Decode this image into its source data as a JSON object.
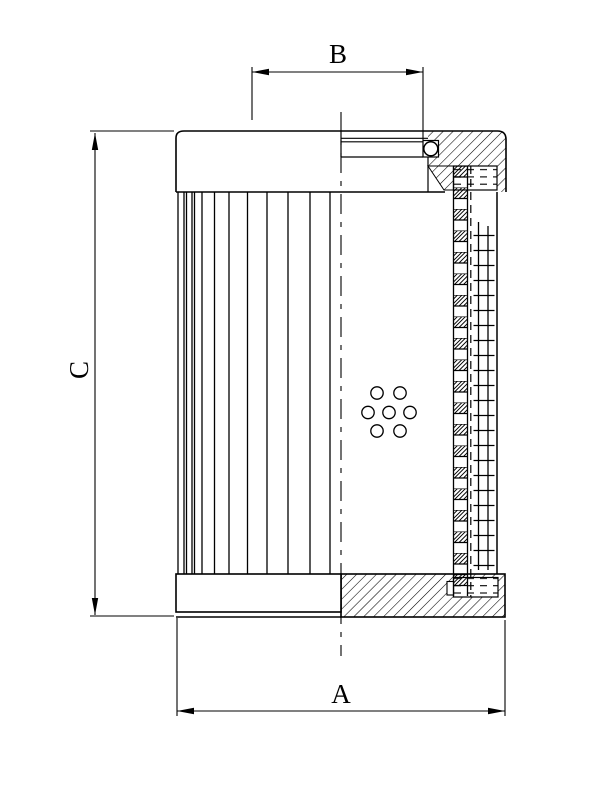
{
  "document": {
    "background_color": "#ffffff",
    "line_color": "#000000"
  },
  "drawing": {
    "kind": "technical-drawing",
    "dimensions": {
      "a": {
        "label": "A"
      },
      "b": {
        "label": "B"
      },
      "c": {
        "label": "C"
      }
    }
  }
}
